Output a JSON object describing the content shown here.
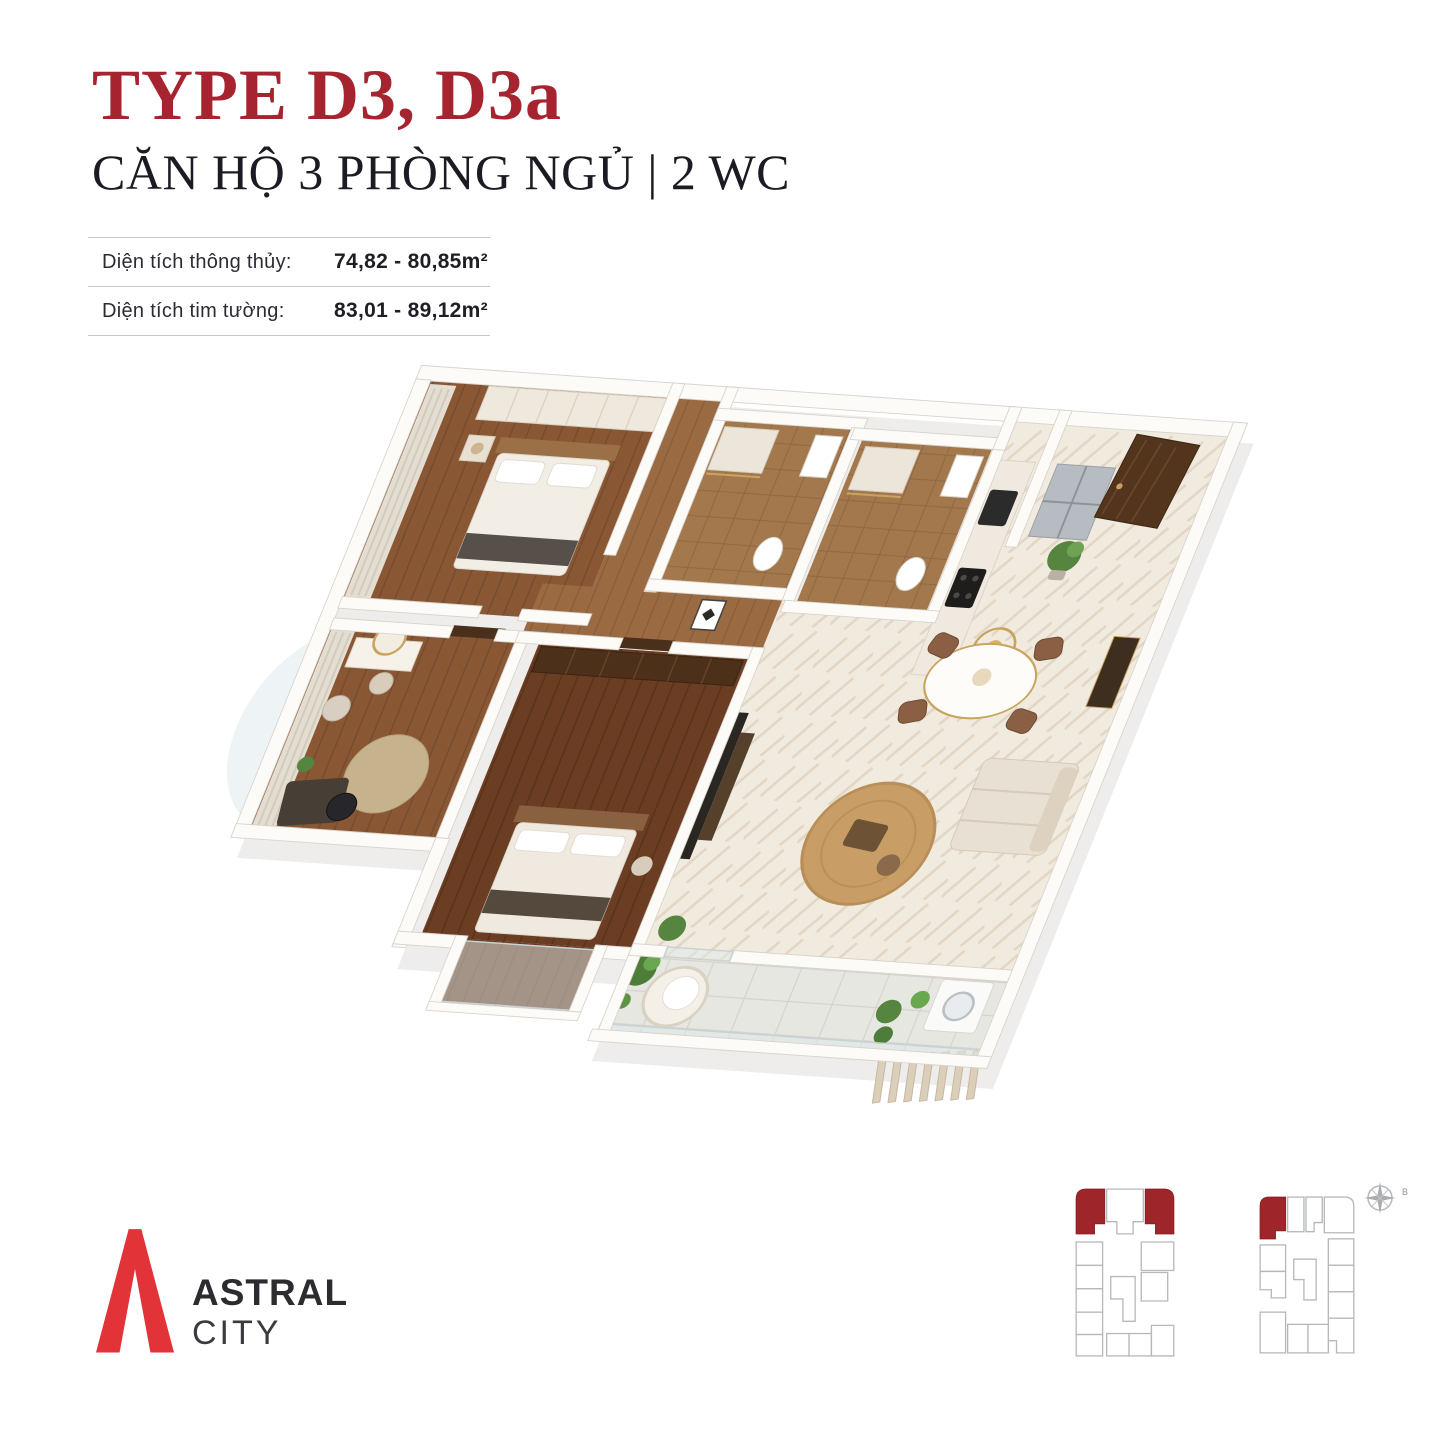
{
  "colors": {
    "title-red": "#A6242F",
    "logo-red": "#E23338",
    "keyplan-red": "#9E262B",
    "keyplan-line": "#B6B9BB",
    "text-dark": "#1B1B24",
    "label-gray": "#2B2B33",
    "rule-gray": "#C6C6C6"
  },
  "header": {
    "title": "TYPE D3, D3a",
    "subtitle": "CĂN HỘ 3 PHÒNG NGỦ | 2 WC"
  },
  "area_table": {
    "rows": [
      {
        "label": "Diện tích thông thủy:",
        "value": "74,82 - 80,85m²"
      },
      {
        "label": "Diện tích tim tường:",
        "value": "83,01 - 89,12m²"
      }
    ]
  },
  "logo": {
    "name_top": "ASTRAL",
    "name_bottom": "CITY"
  },
  "keyplans": {
    "compass_label": "B"
  }
}
